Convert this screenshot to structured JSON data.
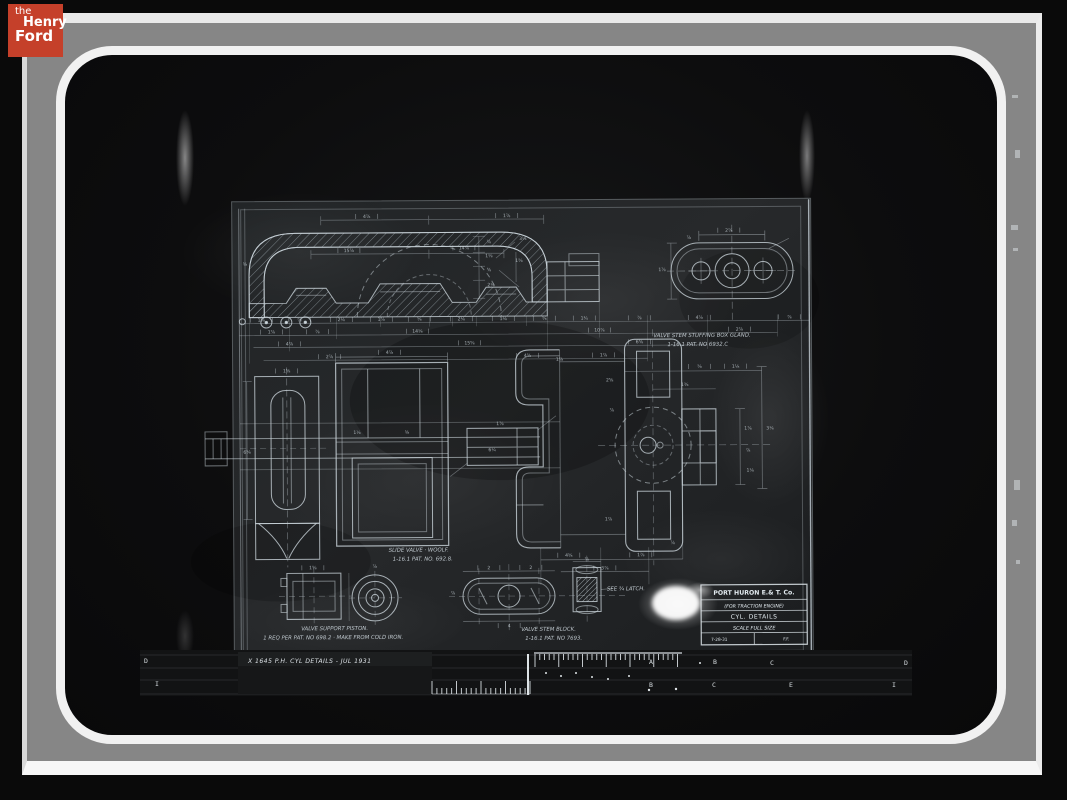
{
  "colors": {
    "logo_bg": "#c5402a",
    "plate_gray": "#868686",
    "frame_white": "#f1f1f1",
    "line_work": "#c9d3d9",
    "background": "#0a0a0a"
  },
  "logo": {
    "line1": "the",
    "line2": "Henry",
    "line3": "Ford"
  },
  "drawing": {
    "title_block": {
      "line1": "PORT HURON E.& T. Co.",
      "line2": "(FOR TRACTION ENGINE)",
      "line3": "CYL. DETAILS",
      "line4": "SCALE  FULL SIZE",
      "date": "7-28-31",
      "initials": "F.F."
    },
    "annotations": [
      {
        "t": "VALVE STEM STUFFING BOX GLAND.",
        "x": 654,
        "y": 338
      },
      {
        "t": "1-16.1  PAT. NO 6932.C",
        "x": 668,
        "y": 347
      },
      {
        "t": "SLIDE VALVE · WOOLF.",
        "x": 388,
        "y": 551
      },
      {
        "t": "1-16.1  PAT. NO. 692.8.",
        "x": 392,
        "y": 560
      },
      {
        "t": "SEE ¾ LATCH.",
        "x": 606,
        "y": 591
      },
      {
        "t": "VALVE SUPPORT PISTON.",
        "x": 300,
        "y": 629
      },
      {
        "t": "1 REQ PER PAT. NO 698.2 · MAKE FROM COLD IRON.",
        "x": 262,
        "y": 638
      },
      {
        "t": "VALVE STEM BLOCK.",
        "x": 520,
        "y": 631
      },
      {
        "t": "1-16.1 PAT. NO 7693.",
        "x": 524,
        "y": 640
      }
    ],
    "dim_labels": [
      {
        "t": "1⅝",
        "x": 262,
        "y": 320,
        "k": 1
      },
      {
        "t": "⅞",
        "x": 300,
        "y": 320,
        "k": 1
      },
      {
        "t": "2⅛",
        "x": 342,
        "y": 320,
        "k": 1
      },
      {
        "t": "1⅞",
        "x": 382,
        "y": 320,
        "k": 1
      },
      {
        "t": "⅝",
        "x": 420,
        "y": 320,
        "k": 1
      },
      {
        "t": "2⅛",
        "x": 462,
        "y": 320,
        "k": 1
      },
      {
        "t": "1⅛",
        "x": 504,
        "y": 320,
        "k": 1
      },
      {
        "t": "⅝",
        "x": 545,
        "y": 320,
        "k": 1
      },
      {
        "t": "1¾",
        "x": 585,
        "y": 320,
        "k": 1
      },
      {
        "t": "⅞",
        "x": 640,
        "y": 320,
        "k": 1
      },
      {
        "t": "4⅞",
        "x": 700,
        "y": 320,
        "k": 1
      },
      {
        "t": "⅞",
        "x": 790,
        "y": 320,
        "k": 1
      },
      {
        "t": "1⅞",
        "x": 272,
        "y": 332,
        "k": 1
      },
      {
        "t": "⅞",
        "x": 318,
        "y": 332,
        "k": 1
      },
      {
        "t": "14⅛",
        "x": 418,
        "y": 332,
        "k": 1
      },
      {
        "t": "10⅞",
        "x": 600,
        "y": 332,
        "k": 1
      },
      {
        "t": "2⅞",
        "x": 740,
        "y": 332,
        "k": 1
      },
      {
        "t": "4⅞",
        "x": 290,
        "y": 344,
        "k": 1
      },
      {
        "t": "15⅝",
        "x": 470,
        "y": 344,
        "k": 1
      },
      {
        "t": "6⅝",
        "x": 640,
        "y": 344,
        "k": 1
      },
      {
        "t": "2⅞",
        "x": 330,
        "y": 357,
        "k": 1
      },
      {
        "t": "4⅝",
        "x": 528,
        "y": 357,
        "k": 1
      },
      {
        "t": "1⅞",
        "x": 604,
        "y": 357,
        "k": 1
      },
      {
        "t": "4⅞",
        "x": 368,
        "y": 217,
        "k": 1
      },
      {
        "t": "1⅞",
        "x": 508,
        "y": 217,
        "k": 1
      },
      {
        "t": "15⅞",
        "x": 350,
        "y": 251,
        "k": 1
      },
      {
        "t": "14⅞",
        "x": 465,
        "y": 249,
        "k": 1
      },
      {
        "t": "⅞",
        "x": 490,
        "y": 243
      },
      {
        "t": "1⅛",
        "x": 490,
        "y": 257
      },
      {
        "t": "⅝",
        "x": 490,
        "y": 271
      },
      {
        "t": "2⅛",
        "x": 492,
        "y": 286
      },
      {
        "t": "1⅝",
        "x": 520,
        "y": 262
      },
      {
        "t": "3⅛",
        "x": 524,
        "y": 240
      },
      {
        "t": "⅝",
        "x": 246,
        "y": 264
      },
      {
        "t": "2⅞",
        "x": 730,
        "y": 233,
        "k": 1
      },
      {
        "t": "1⅞",
        "x": 663,
        "y": 272
      },
      {
        "t": "⅞",
        "x": 690,
        "y": 240
      },
      {
        "t": "1⅝",
        "x": 287,
        "y": 371,
        "k": 1
      },
      {
        "t": "6⅝",
        "x": 247,
        "y": 452
      },
      {
        "t": "4⅞",
        "x": 390,
        "y": 353,
        "k": 1
      },
      {
        "t": "1⅛",
        "x": 357,
        "y": 433
      },
      {
        "t": "⅝",
        "x": 407,
        "y": 433
      },
      {
        "t": "6¼",
        "x": 492,
        "y": 451
      },
      {
        "t": "1⅞",
        "x": 500,
        "y": 425
      },
      {
        "t": "1⅞",
        "x": 560,
        "y": 361
      },
      {
        "t": "⅝",
        "x": 700,
        "y": 369,
        "k": 1
      },
      {
        "t": "1⅛",
        "x": 736,
        "y": 369,
        "k": 1
      },
      {
        "t": "1⅜",
        "x": 685,
        "y": 387
      },
      {
        "t": "1⅞",
        "x": 748,
        "y": 431
      },
      {
        "t": "⅞",
        "x": 748,
        "y": 453
      },
      {
        "t": "1⅛",
        "x": 750,
        "y": 473
      },
      {
        "t": "3⅛",
        "x": 770,
        "y": 431
      },
      {
        "t": "2⅝",
        "x": 610,
        "y": 382
      },
      {
        "t": "⅞",
        "x": 612,
        "y": 412
      },
      {
        "t": "1⅞",
        "x": 608,
        "y": 521
      },
      {
        "t": "⅞",
        "x": 672,
        "y": 545
      },
      {
        "t": "4⅝",
        "x": 568,
        "y": 557,
        "k": 1
      },
      {
        "t": "1⅞",
        "x": 640,
        "y": 557,
        "k": 1
      },
      {
        "t": "3⅞",
        "x": 604,
        "y": 570,
        "k": 1
      },
      {
        "t": "1⅝",
        "x": 312,
        "y": 568,
        "k": 1
      },
      {
        "t": "⅞",
        "x": 374,
        "y": 567
      },
      {
        "t": "2",
        "x": 488,
        "y": 569,
        "k": 1
      },
      {
        "t": "2",
        "x": 530,
        "y": 569,
        "k": 1
      },
      {
        "t": "4",
        "x": 508,
        "y": 627,
        "k": 1
      },
      {
        "t": "⅞",
        "x": 586,
        "y": 561
      },
      {
        "t": "⅞",
        "x": 452,
        "y": 594
      }
    ]
  },
  "ruler": {
    "handwriting": "X 1645  P.H. CYL DETAILS  -  JUL 1931",
    "letters": [
      {
        "t": "D",
        "x": 146,
        "y": 663
      },
      {
        "t": "A",
        "x": 651,
        "y": 664
      },
      {
        "t": "B",
        "x": 715,
        "y": 664
      },
      {
        "t": "C",
        "x": 772,
        "y": 665
      },
      {
        "t": "D",
        "x": 906,
        "y": 665
      },
      {
        "t": "I",
        "x": 157,
        "y": 686
      },
      {
        "t": "B",
        "x": 651,
        "y": 687
      },
      {
        "t": "C",
        "x": 714,
        "y": 687
      },
      {
        "t": "E",
        "x": 791,
        "y": 687
      },
      {
        "t": "I",
        "x": 894,
        "y": 687
      }
    ],
    "tick_groups": [
      {
        "x0": 432,
        "step": 4.9,
        "n": 21,
        "base": 694,
        "short": 688,
        "tall": 681
      },
      {
        "x0": 535,
        "step": 4.75,
        "n": 31,
        "base": 654,
        "short": 660,
        "tall": 667
      }
    ]
  }
}
